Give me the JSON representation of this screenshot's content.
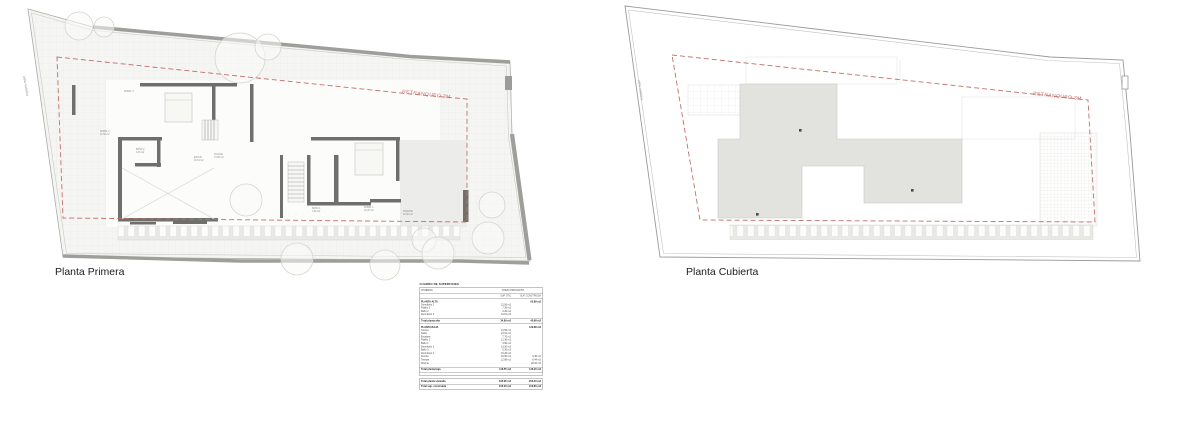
{
  "plans": {
    "left": {
      "label": "Planta Primera",
      "setback_label": "RETRANQUEO 3M",
      "fence_label": "valla metálica",
      "room_labels": [
        {
          "text": "DORM. 2",
          "x": 100,
          "y": 132
        },
        {
          "text": "12.56 m2",
          "x": 100,
          "y": 135
        },
        {
          "text": "BAÑO 2",
          "x": 136,
          "y": 150
        },
        {
          "text": "4.36 m2",
          "x": 136,
          "y": 153
        },
        {
          "text": "ESTAR",
          "x": 194,
          "y": 158
        },
        {
          "text": "23.61 m2",
          "x": 194,
          "y": 161
        },
        {
          "text": "COCINA",
          "x": 214,
          "y": 155
        },
        {
          "text": "14.56 m2",
          "x": 214,
          "y": 158
        },
        {
          "text": "BAÑO 1",
          "x": 312,
          "y": 209
        },
        {
          "text": "3.96 m2",
          "x": 312,
          "y": 212
        },
        {
          "text": "DORM. 1",
          "x": 364,
          "y": 208
        },
        {
          "text": "13.26 m2",
          "x": 364,
          "y": 211
        },
        {
          "text": "PORCHE",
          "x": 403,
          "y": 212
        },
        {
          "text": "10.60 m2",
          "x": 403,
          "y": 215
        },
        {
          "text": "DORM. 3",
          "x": 124,
          "y": 92
        }
      ]
    },
    "right": {
      "label": "Planta Cubierta",
      "setback_label": "RETRANQUEO 3M",
      "fence_label": "valla metálica"
    }
  },
  "colors": {
    "setback_red": "#c2706a",
    "wall_gray": "#6f6f6c",
    "roof_fill": "#e2e2de",
    "boundary_gray": "#9c9c99"
  },
  "surface_table": {
    "title": "CUADRO DE SUPERFICIES",
    "group_left": "VIVIENDA",
    "group_right": "COMO PROYECTO",
    "col_util": "SUP. ÚTIL",
    "col_const": "SUP. CONSTRUIDA",
    "sections": [
      {
        "name": "PLANTA ALTA",
        "name_value": "95.89 m2",
        "rows": [
          [
            "Dormitorio 2",
            "12.56 m2",
            ""
          ],
          [
            "Pasillo 2",
            "7.36 m2",
            ""
          ],
          [
            "Baño 2",
            "4.36 m2",
            ""
          ],
          [
            "Dormitorio 3",
            "10.61 m2",
            ""
          ]
        ],
        "total": [
          "Total planta alta",
          "34.89 m2",
          "40.89 m2"
        ]
      },
      {
        "name": "PLANTA BAJA",
        "name_value": "139.88 m2",
        "rows": [
          [
            "Cocina",
            "14.56 m2",
            ""
          ],
          [
            "Salón",
            "23.61 m2",
            ""
          ],
          [
            "Escalera",
            "7.70 m2",
            ""
          ],
          [
            "Pasillo 1",
            "11.36 m2",
            ""
          ],
          [
            "Baño 1",
            "3.96 m2",
            ""
          ],
          [
            "Dormitorio 1",
            "13.26 m2",
            ""
          ],
          [
            "Baño 3",
            "5.36 m2",
            ""
          ],
          [
            "Dormitorio 4",
            "15.26 m2",
            ""
          ],
          [
            "Porche",
            "10.60 m2",
            "5.30 m2"
          ],
          [
            "Terraza",
            "12.88 m2",
            "6.44 m2"
          ],
          [
            "Piscina",
            "",
            "28.00 m2"
          ]
        ],
        "total": [
          "Total planta baja",
          "118.55 m2",
          "146.20 m2"
        ]
      }
    ],
    "grand_totals": [
      [
        "Total planta vivienda",
        "195.95 m2",
        "203.40 m2"
      ],
      [
        "Total sup. construida",
        "195.20 m2",
        "169.80 m2"
      ]
    ]
  }
}
